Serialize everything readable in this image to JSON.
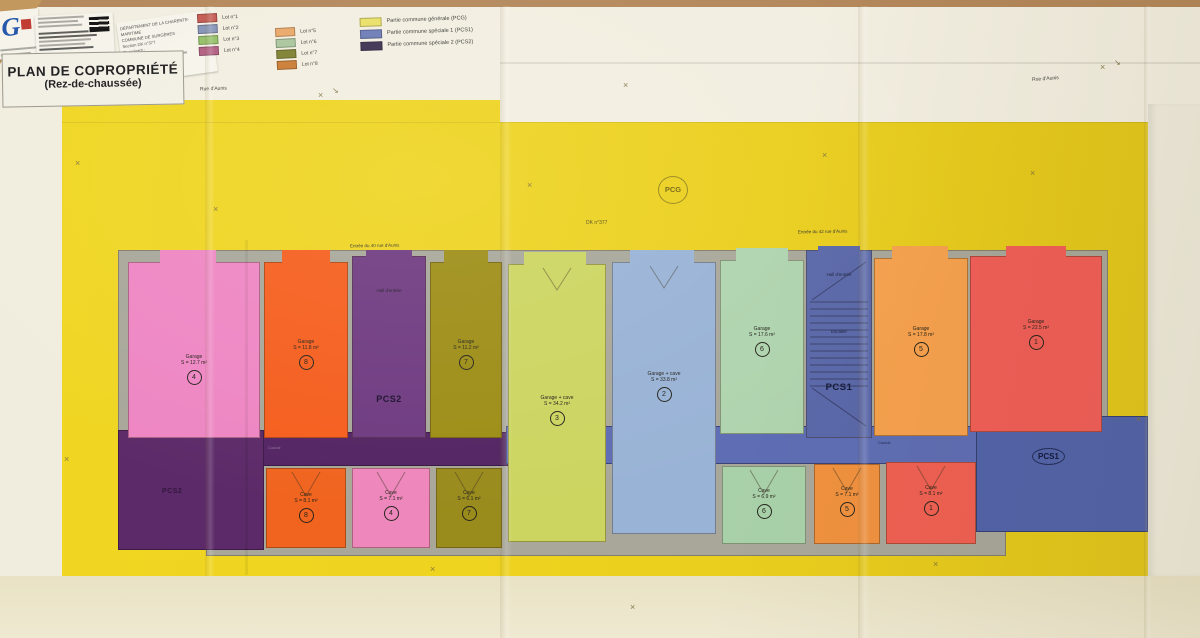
{
  "title_block": {
    "title": "PLAN DE COPROPRIÉTÉ",
    "subtitle": "(Rez-de-chaussée)"
  },
  "header": {
    "logo_text": "G",
    "dept_lines": {
      "l1": "DÉPARTEMENT DE LA CHARENTE-MARITIME",
      "l2": "COMMUNE DE SURGÈRES",
      "l3": "Section DK n°377",
      "l4": "Requérant :"
    }
  },
  "legend": {
    "lots": [
      {
        "label": "Lot n°1",
        "color": "#c45850"
      },
      {
        "label": "Lot n°2",
        "color": "#8492b6"
      },
      {
        "label": "Lot n°3",
        "color": "#94bf66"
      },
      {
        "label": "Lot n°4",
        "color": "#b25c80"
      },
      {
        "label": "Lot n°5",
        "color": "#eaa768"
      },
      {
        "label": "Lot n°6",
        "color": "#a9c59c"
      },
      {
        "label": "Lot n°7",
        "color": "#7d802f"
      },
      {
        "label": "Lot n°8",
        "color": "#ca7a32"
      }
    ],
    "commons": [
      {
        "label": "Partie commune générale (PCG)",
        "color": "#e9df66"
      },
      {
        "label": "Partie commune spéciale 1 (PCS1)",
        "color": "#6b7bb6"
      },
      {
        "label": "Partie commune spéciale 2 (PCS2)",
        "color": "#3b3050"
      }
    ]
  },
  "annotations": {
    "pcg": "PCG",
    "parcel": "DK n°377",
    "entrance_left": "Entrée du 40 rue d'Aunis",
    "entrance_right": "Entrée du 42 rue d'Aunis",
    "street_left": "Rue d'Aunis",
    "street_right": "Rue d'Aunis",
    "corridor": "Couloir",
    "cross_mark": "×",
    "arrow_mark": "↘"
  },
  "zones": {
    "pcs2_block": "PCS2",
    "pcs1_block": "PCS1"
  },
  "rooms_top": [
    {
      "name": "Garage",
      "area": "S = 12.7 m²",
      "num": "4",
      "color": "#ee86c3"
    },
    {
      "name": "Garage",
      "area": "S = 11.8 m²",
      "num": "8",
      "color": "#f55e1d"
    },
    {
      "hall_top": "Hall d'entrée",
      "hall_bottom": "PCS2",
      "color": "#6e3a80"
    },
    {
      "name": "Garage",
      "area": "S = 11.2 m²",
      "num": "7",
      "color": "#9d8d16"
    },
    {
      "name": "Garage + cave",
      "area": "S = 34.2 m²",
      "num": "3",
      "color": "#ccd560"
    },
    {
      "name": "Garage + cave",
      "area": "S = 33.8 m²",
      "num": "2",
      "color": "#99b3d6"
    },
    {
      "name": "Garage",
      "area": "S = 17.6 m²",
      "num": "6",
      "color": "#afd4ae"
    },
    {
      "stair_top": "Hall d'entrée",
      "stair_mid": "Escalier",
      "stair_bottom": "PCS1",
      "color": "#5a68aa"
    },
    {
      "name": "Garage",
      "area": "S = 17.8 m²",
      "num": "5",
      "color": "#f6a14e"
    },
    {
      "name": "Garage",
      "area": "S = 22.5 m²",
      "num": "1",
      "color": "#f05e58"
    }
  ],
  "rooms_bottom": [
    {
      "name": "Cave",
      "area": "S = 8.1 m²",
      "num": "8",
      "color": "#f0641f"
    },
    {
      "name": "Cave",
      "area": "S = 7.1 m²",
      "num": "4",
      "color": "#ee87bc"
    },
    {
      "name": "Cave",
      "area": "S = 6.1 m²",
      "num": "7",
      "color": "#9a8b1d"
    },
    {
      "name": "Cave",
      "area": "S = 6.9 m²",
      "num": "6",
      "color": "#a9d1a9"
    },
    {
      "name": "Cave",
      "area": "S = 7.1 m²",
      "num": "5",
      "color": "#f0913f"
    },
    {
      "name": "Cave",
      "area": "S = 8.1 m²",
      "num": "1",
      "color": "#ef6053"
    }
  ]
}
